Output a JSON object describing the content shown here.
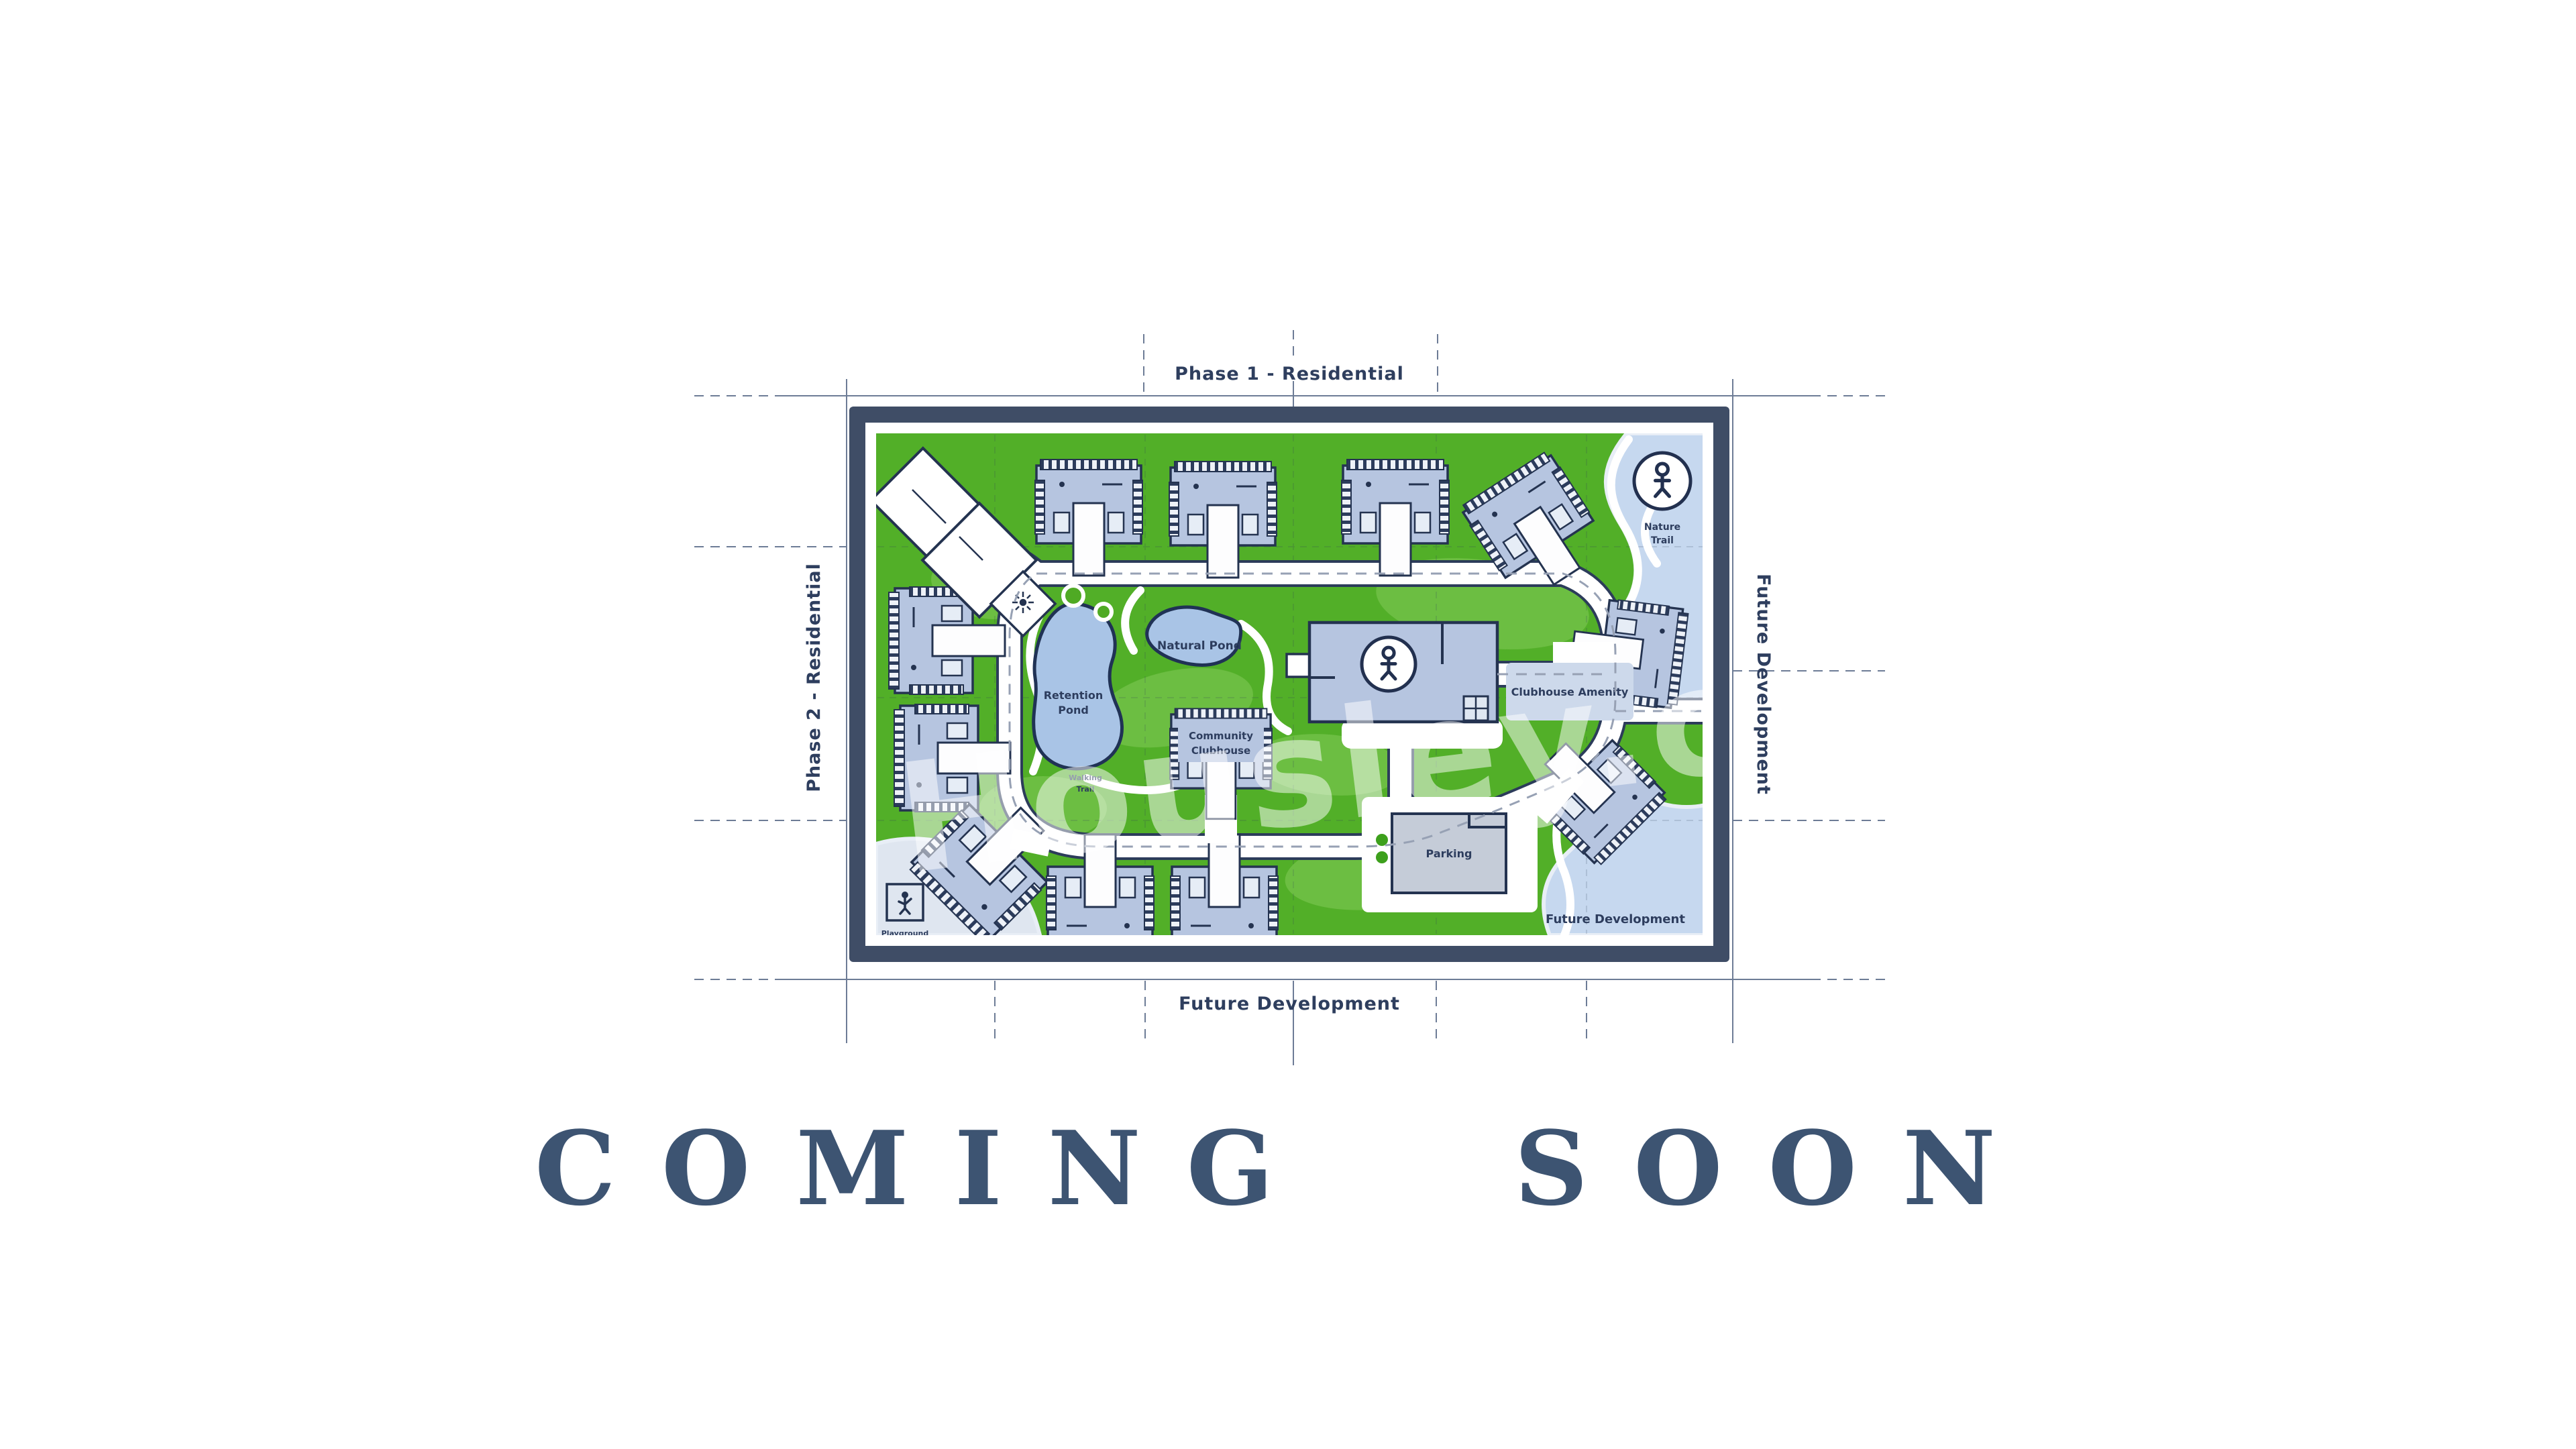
{
  "page": {
    "background": "#ffffff"
  },
  "banner": {
    "text": "COMING SOON",
    "color": "#3d5472"
  },
  "watermark": {
    "text": "Housley.com"
  },
  "plan": {
    "colors": {
      "frame": "#3f4d66",
      "lawn": "#52af28",
      "lawn_light": "#8ed063",
      "water": "#c6d8ef",
      "pond": "#a9c4e6",
      "pond_outline": "#203255",
      "building_fill": "#b6c5e0",
      "building_outline": "#243350",
      "road": "#ffffff",
      "road_casing": "#2c3c5a",
      "blueprint_line": "#6d7c96",
      "label_ink": "#2d3d5e"
    },
    "labels": {
      "phase1": "Phase 1 - Residential",
      "phase2": "Phase 2 - Residential",
      "future_dev_bottom": "Future Development",
      "future_dev_right": "Future Development",
      "future_dev_area": "Future Development",
      "natural_pond": "Natural Pond",
      "retention_line1": "Retention",
      "retention_line2": "Pond",
      "clubhouse_annex": "Clubhouse Amenity",
      "community_line1": "Community",
      "community_line2": "Clubhouse",
      "parking": "Parking",
      "playground_line1": "Playground",
      "playground_line2": "Area",
      "trail_line1": "Walking",
      "trail_line2": "Trail",
      "nature_line1": "Nature",
      "nature_line2": "Trail"
    }
  }
}
